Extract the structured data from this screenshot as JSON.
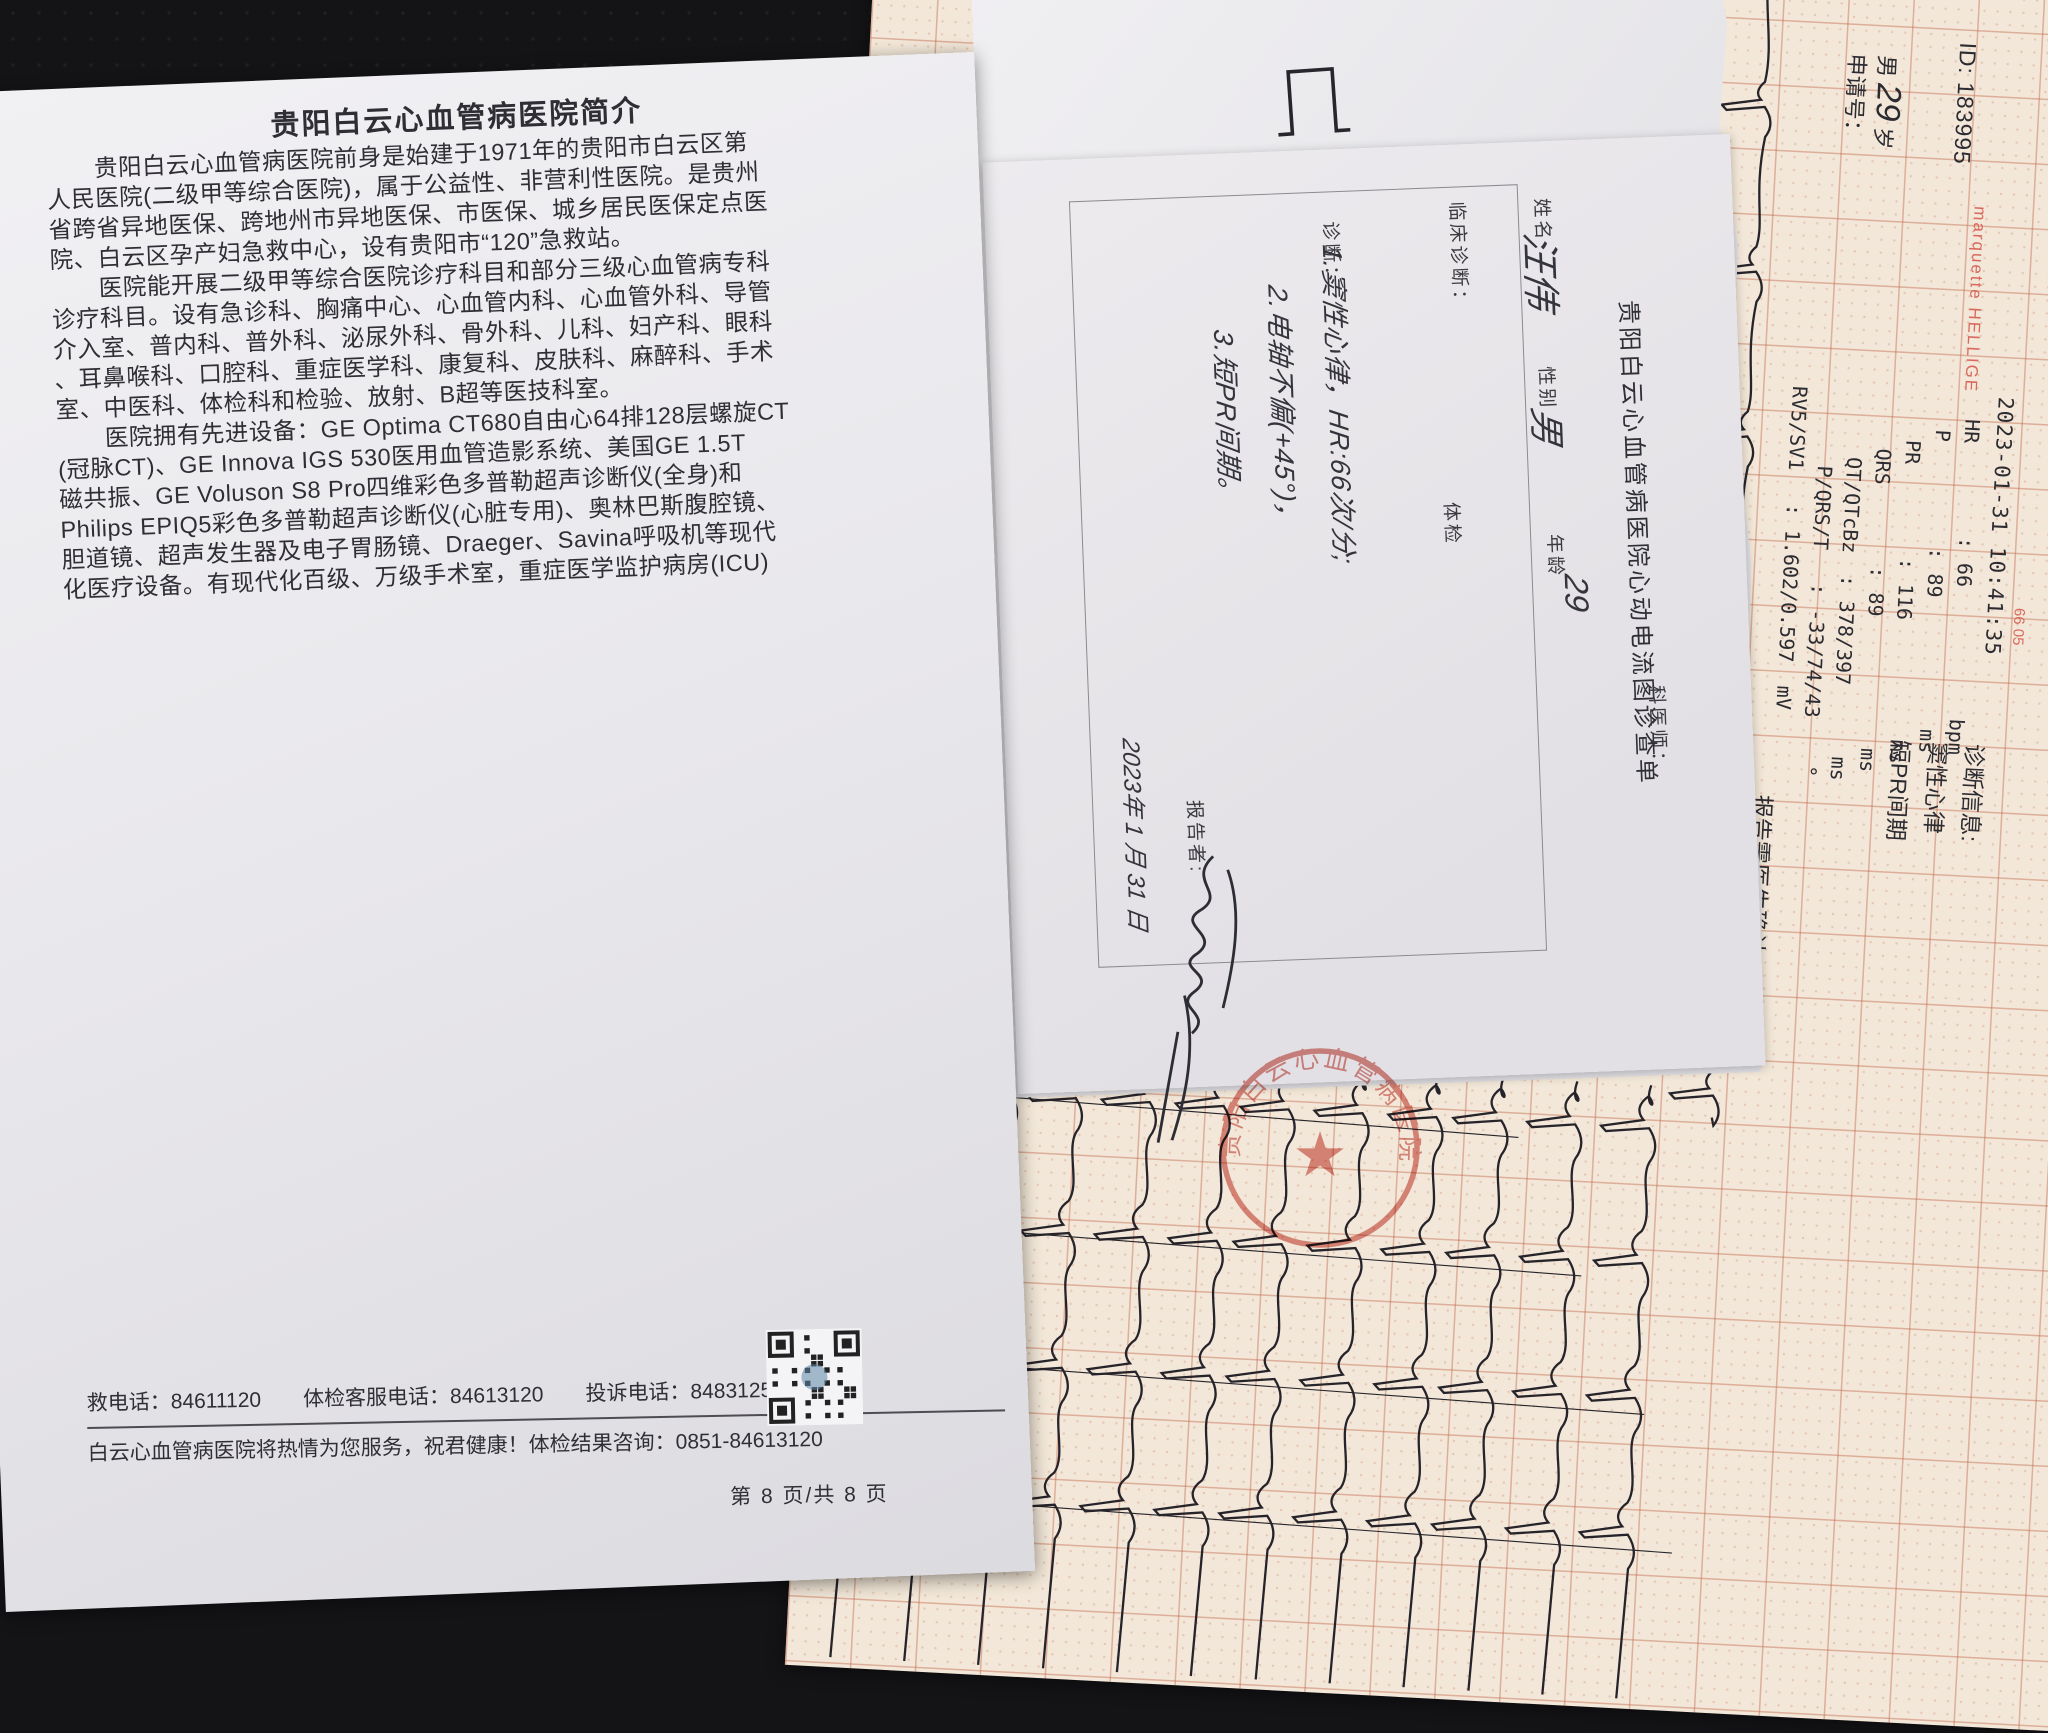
{
  "intro_page": {
    "title": "贵阳白云心血管病医院简介",
    "paragraphs": [
      "　　贵阳白云心血管病医院前身是始建于1971年的贵阳市白云区第",
      "人民医院(二级甲等综合医院)，属于公益性、非营利性医院。是贵州",
      "省跨省异地医保、跨地州市异地医保、市医保、城乡居民医保定点医",
      "院、白云区孕产妇急救中心，设有贵阳市“120”急救站。",
      "　　医院能开展二级甲等综合医院诊疗科目和部分三级心血管病专科",
      "诊疗科目。设有急诊科、胸痛中心、心血管内科、心血管外科、导管",
      "介入室、普内科、普外科、泌尿外科、骨外科、儿科、妇产科、眼科",
      "、耳鼻喉科、口腔科、重症医学科、康复科、皮肤科、麻醉科、手术",
      "室、中医科、体检科和检验、放射、B超等医技科室。",
      "　　医院拥有先进设备：GE Optima CT680自由心64排128层螺旋CT",
      "(冠脉CT)、GE Innova IGS 530医用血管造影系统、美国GE 1.5T",
      "磁共振、GE Voluson S8 Pro四维彩色多普勒超声诊断仪(全身)和",
      "Philips EPIQ5彩色多普勒超声诊断仪(心脏专用)、奥林巴斯腹腔镜、",
      "胆道镜、超声发生器及电子胃肠镜、Draeger、Savina呼吸机等现代",
      "化医疗设备。有现代化百级、万级手术室，重症医学监护病房(ICU)"
    ],
    "footer": {
      "hotline_line": "救电话：84611120　　体检客服电话：84613120　　投诉电话：84831254",
      "service_line": "白云心血管病医院将热情为您服务，祝君健康！体检结果咨询：0851-84613120",
      "page_number": "第 8 页/共 8 页"
    }
  },
  "ecg_form": {
    "title": "贵阳白云心血管病医院心动电流图诊查单",
    "labels": {
      "name": "姓名",
      "gender": "性别",
      "age": "年龄",
      "clinical_diagnosis": "临床诊断：",
      "diagnosis": "诊断：",
      "checkup": "体检",
      "physician": "科医师：",
      "reporter": "报告者:"
    },
    "handwritten": {
      "name": "汪伟",
      "gender": "男",
      "age": "29",
      "diagnosis_lines": [
        "1.窦性心律，HR:66次/分;",
        "2.电轴不偏(+45°)，",
        "3.短PR间期。"
      ],
      "date": "2023年 1 月 31 日"
    }
  },
  "ecg_paper": {
    "id_line": "ID: 183995",
    "patient_sex": "男",
    "age_handwritten": "29",
    "age_unit": "岁",
    "request_no_label": "申请号：",
    "brand": "marquette HELLIGE",
    "datetime": "2023-01-31 10:41:35",
    "edge_code": "66 05",
    "measurements": [
      {
        "label": "HR",
        "value": "66",
        "unit": "bpm"
      },
      {
        "label": "P",
        "value": "89",
        "unit": "ms"
      },
      {
        "label": "PR",
        "value": "116",
        "unit": "ms"
      },
      {
        "label": "QRS",
        "value": "89",
        "unit": "ms"
      },
      {
        "label": "QT/QTcBz",
        "value": "378/397",
        "unit": "ms"
      },
      {
        "label": "P/QRS/T",
        "value": "-33/74/43",
        "unit": "°"
      },
      {
        "label": "RV5/SV1",
        "value": "1.602/0.597",
        "unit": "mV"
      }
    ],
    "diagnosis_info_header": "诊断信息:",
    "diagnosis_info": [
      "窦性心律",
      "短PR间期"
    ],
    "confirm_note": "报告需医生确认："
  },
  "stamp": {
    "text": "贵阳白云心血管病医院",
    "star": "★",
    "color": "#c63b2f"
  }
}
